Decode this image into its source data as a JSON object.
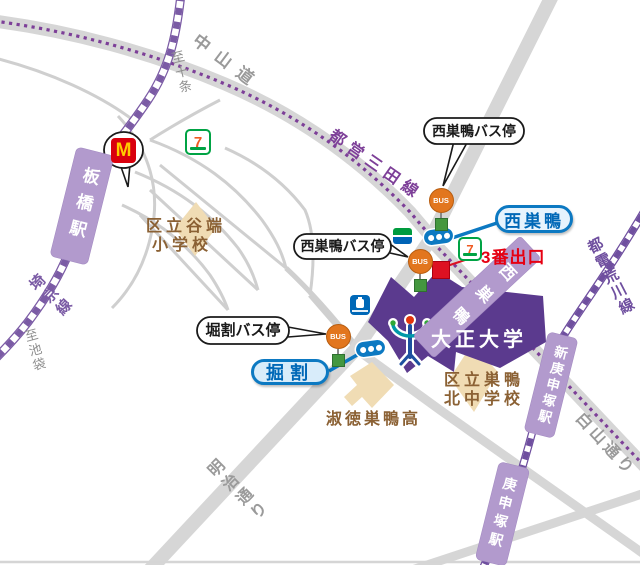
{
  "map": {
    "title": "Nishi-Sugamo / Taisho University area map",
    "roads": {
      "nakasendo": "中山道",
      "hakusan_dori": "白山通り",
      "meiji_dori": "明治通り"
    },
    "rail_lines": {
      "mita_line": "都営三田線",
      "saikyo_line": "埼京線",
      "toden_arakawa_line": "都電荒川線"
    },
    "directions": {
      "to_jujo": "至十条",
      "to_ikebukuro": "至池袋"
    },
    "stations": {
      "itabashi": "板橋駅",
      "nishisugamo_band": "西巣鴨",
      "shinkoshinzuka": "新庚申塚駅",
      "koshinzuka": "庚申塚駅"
    },
    "callouts": {
      "nishisugamo_bus_top": "西巣鴨バス停",
      "nishisugamo_bus_left": "西巣鴨バス停",
      "horiwari_bus": "堀割バス停"
    },
    "capsules": {
      "nishisugamo": "西巣鴨",
      "horiwari": "掘割"
    },
    "poi": {
      "exit3": "3番出口",
      "taisho_university": "大正大学",
      "yabata_elementary_line1": "区立谷端",
      "yabata_elementary_line2": "小学校",
      "sugamo_kita_line1": "区立巣鴨",
      "sugamo_kita_line2": "北中学校",
      "shukutoku_sugamo": "淑徳巣鴨高"
    },
    "glyphs": {
      "bus": "BUS",
      "mcdonalds_m": "M",
      "seven": "7"
    },
    "icons": [
      "mcdonalds-icon",
      "seven-eleven-icon",
      "family-mart-icon",
      "lawson-icon",
      "bus-stop-icon",
      "station-entrance-icon",
      "taisho-university-logo",
      "exit3-marker"
    ],
    "colors": {
      "road": "#d6d6d6",
      "rail_jr": "#7b5ba5",
      "mita_dots": "#7d3f98",
      "toden": "#6f4f9f",
      "station_band": "#b29acd",
      "campus": "#5b3a8e",
      "building": "#f0dcb4",
      "blue_border": "#0c79c2",
      "blue_text": "#0068b7",
      "red": "#e60012",
      "bus_orange": "#e2761e",
      "base_green": "#44973f",
      "school_brown": "#8b6134",
      "road_text": "#9a9a9a"
    }
  }
}
